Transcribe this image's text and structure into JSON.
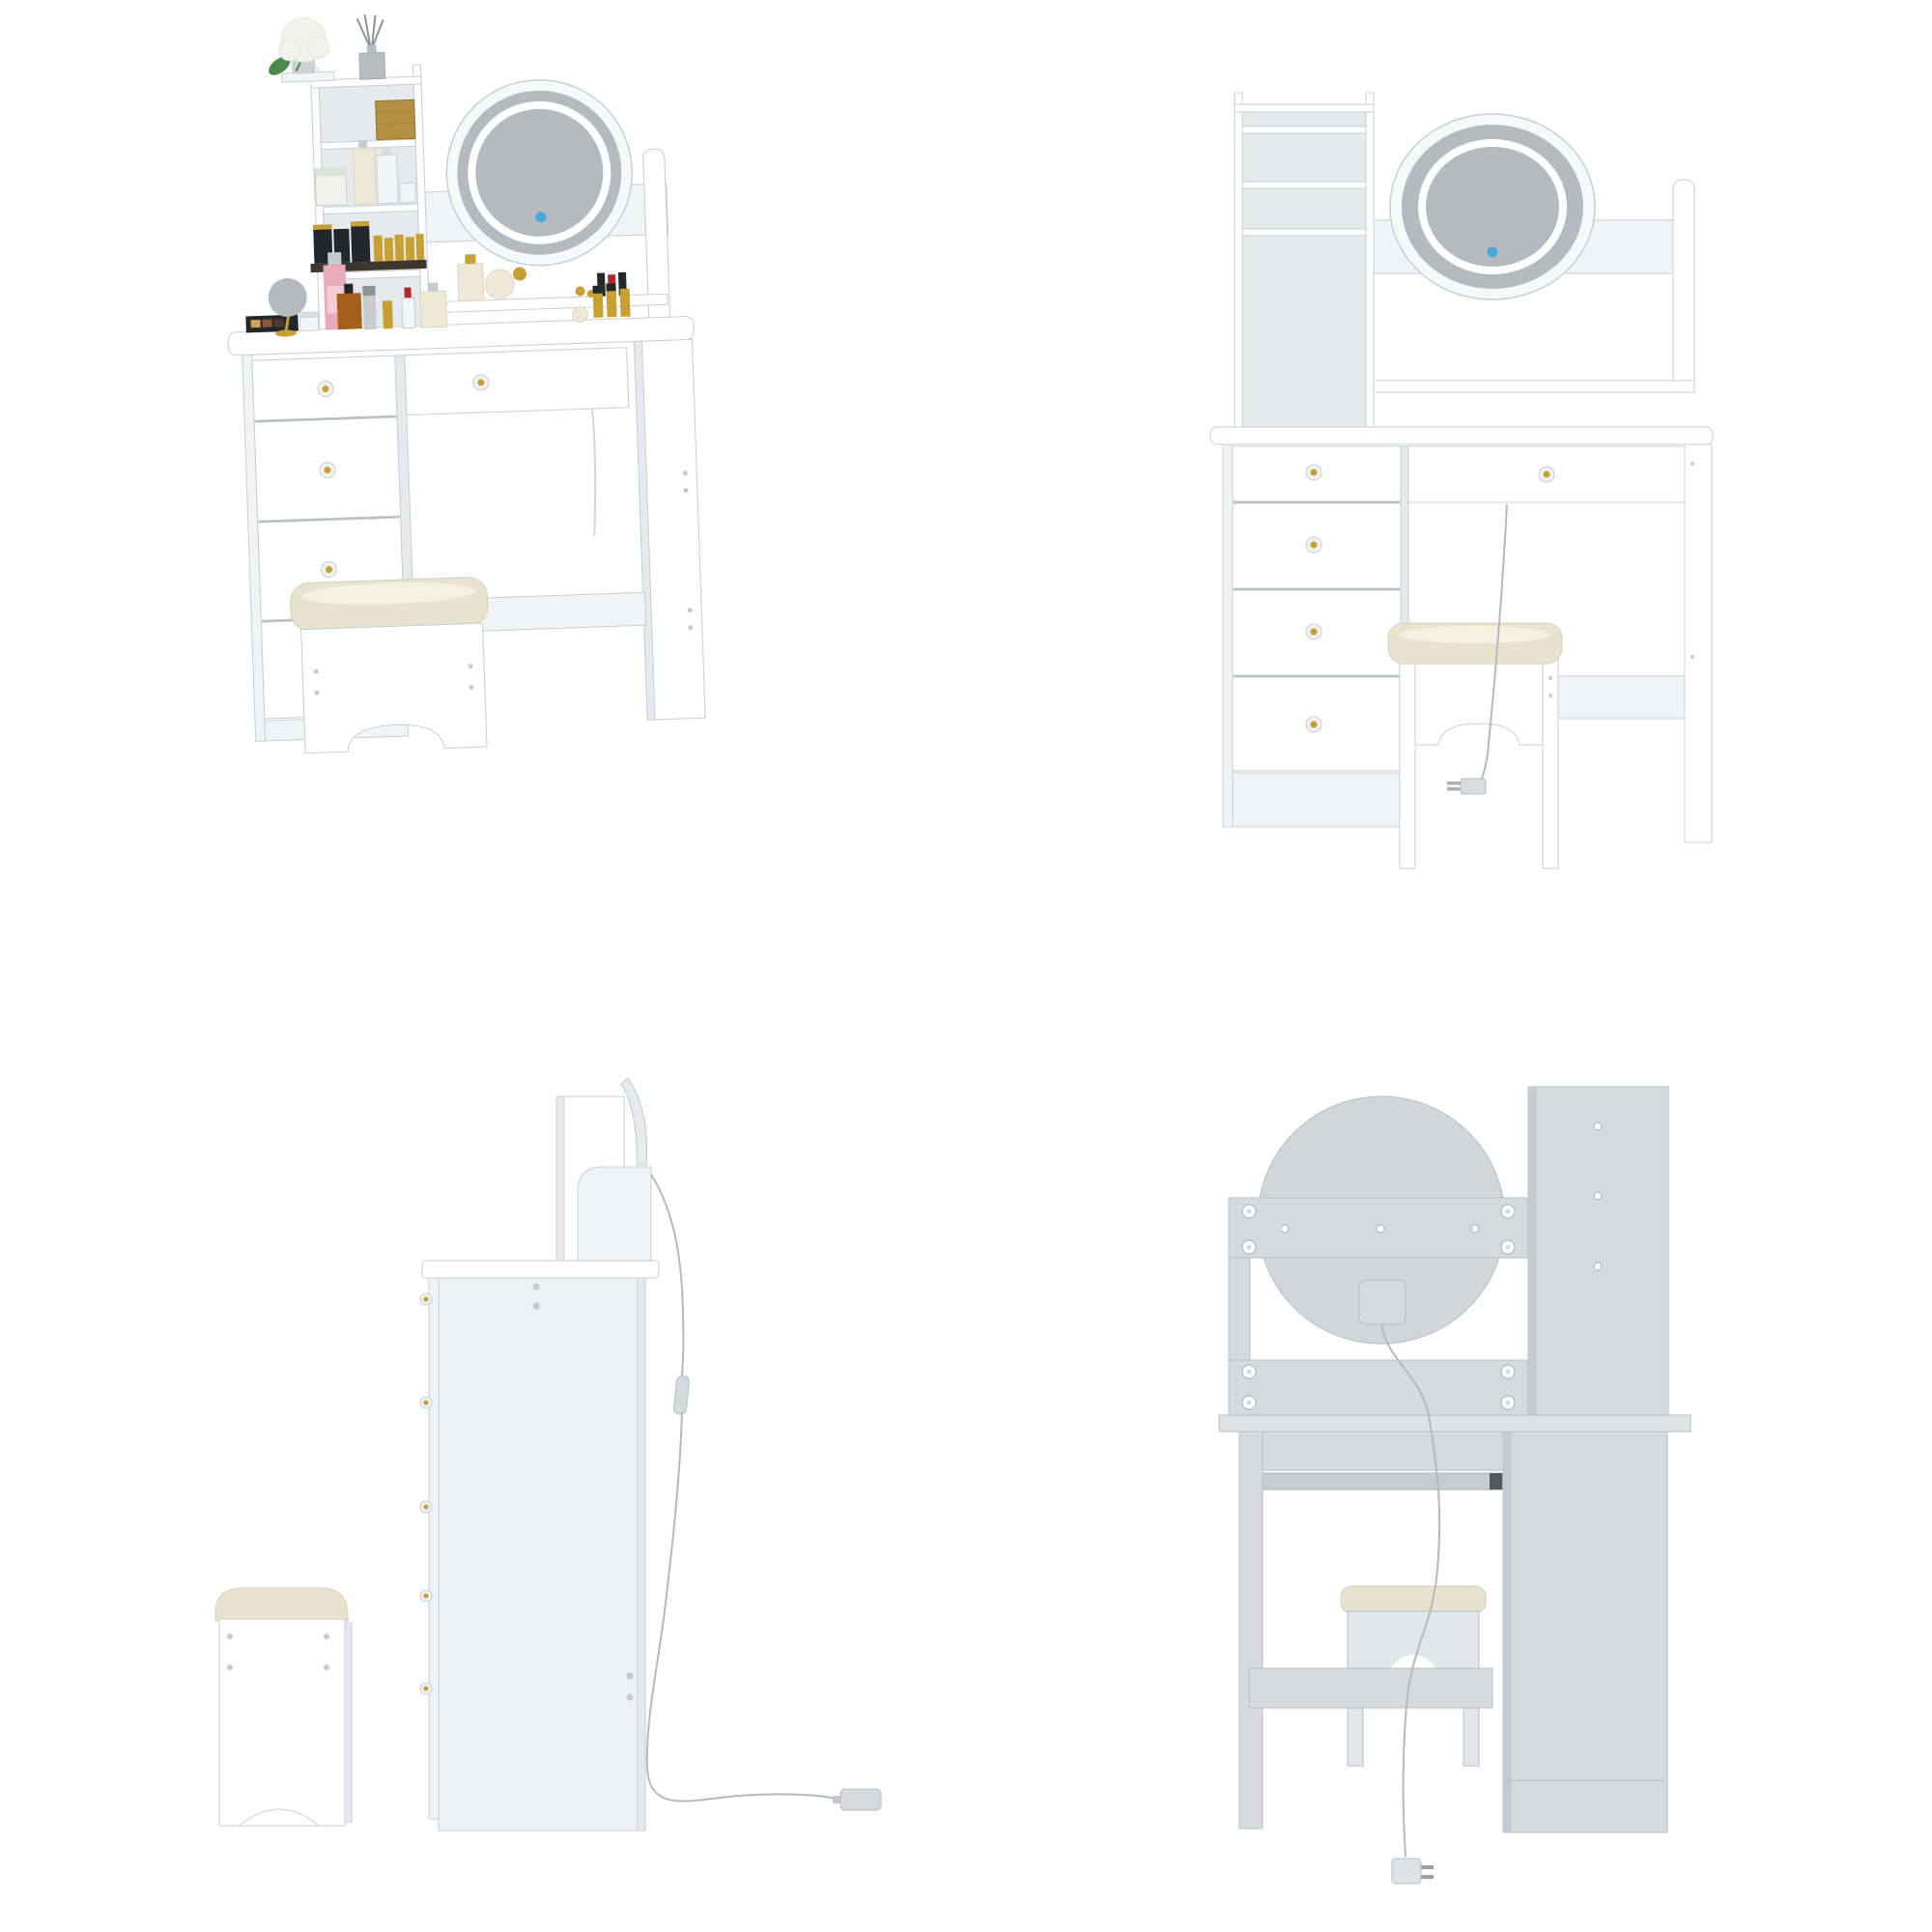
{
  "page": {
    "background": "#ffffff",
    "content": "four product views of a white vanity dressing table set with round LED mirror, shelf hutch, five drawers and cushioned stool"
  },
  "colors": {
    "panel": "#ffffff",
    "panel2": "#f1f3f5",
    "panel3": "#e7eaec",
    "edge": "#c9ced3",
    "seam": "#6a7074",
    "side_panel": "#eef0f2",
    "frame": "#f6f8f9",
    "glass": "#b5bac0",
    "led": "#ffffff",
    "touch": "#4aa7de",
    "gold": "#c6a032",
    "crystal": "#eff1f3",
    "cushion": "#e8e2cf",
    "cushion_hi": "#f6f2e5",
    "cushion_edge": "#d5cfbb",
    "gray1": "#d6dadc",
    "gray2": "#d2d6d9",
    "gray3": "#e0e3e5",
    "gray_dark": "#c6cbce",
    "gray_edge": "#b9bec2",
    "screw": "#fcfdfd",
    "screw_edge": "#a9afb3",
    "dot": "#c5cacd",
    "cord": "#b5b9bd",
    "metal": "#c8ccd0",
    "metal_dark": "#53585c",
    "flower": "#f2f3ee",
    "leaf": "#4c8a4a",
    "vase": "#ccd0d3",
    "diffuser": "#b9bdc1",
    "stick": "#8f9498",
    "gold_box": "#b39043",
    "candle": "#f0f1ea",
    "candle_lid": "#dfe4d6",
    "cream_bottle": "#efe8d8",
    "white_bottle": "#f4f5f6",
    "black": "#24262a",
    "dark_tray": "#3c362c",
    "red": "#b32733",
    "pink": "#e8abbb",
    "pink_light": "#f3cdd6",
    "amber": "#a55f1d",
    "silver": "#c7cbcf",
    "lid_gray": "#d8dcdf"
  },
  "product": {
    "name": "vanity dressing table set",
    "finish": "white",
    "mirror": "round LED mirror with blue touch switch",
    "drawer_count": 5,
    "knobs": "crystal knobs with gold centers",
    "stool": "cushioned stool with arched cutout",
    "power": "corded LED light with inline switch and two-prong plug"
  },
  "views": {
    "front_styled": {
      "position": "top-left",
      "label": "styled front view with cosmetics decor",
      "parts": [
        "4-tier open shelf hutch",
        "round LED mirror",
        "touch switch",
        "open display shelf",
        "tabletop",
        "4 side drawers",
        "1 center drawer",
        "right leg panel",
        "stretcher",
        "cushioned stool"
      ],
      "decor": [
        "white hydrangea in vase",
        "reed diffuser",
        "gold gift box",
        "scented candle",
        "lotion bottles",
        "lipstick collection on tray",
        "gold hand mirror",
        "perfume bottles",
        "makeup palette",
        "assorted cosmetics"
      ]
    },
    "front_plain": {
      "position": "top-right",
      "label": "plain front elevation",
      "parts": [
        "4-tier open shelf hutch",
        "round LED mirror",
        "touch switch",
        "open display shelf",
        "tabletop",
        "4 side drawers",
        "1 center drawer",
        "right leg panel",
        "stretcher",
        "cushioned stool",
        "power cord with plug"
      ]
    },
    "side": {
      "position": "bottom-left",
      "label": "side elevation",
      "parts": [
        "cushioned stool side profile",
        "desk side panel",
        "protruding drawer knobs",
        "hutch side panel",
        "mirror edge arc",
        "mirror support panel",
        "power cord with inline switch",
        "plug resting on floor"
      ]
    },
    "back": {
      "position": "bottom-right",
      "label": "back elevation",
      "parts": [
        "round mirror back panel",
        "upper mounting rail with cam screws",
        "lower mounting rail with cam screws",
        "LED driver box",
        "hutch back panel with screws",
        "tabletop edge",
        "desk back rail",
        "metal drawer slide",
        "stool back with arch",
        "stretcher",
        "drawer cabinet back",
        "power cord with two-prong plug"
      ]
    }
  }
}
